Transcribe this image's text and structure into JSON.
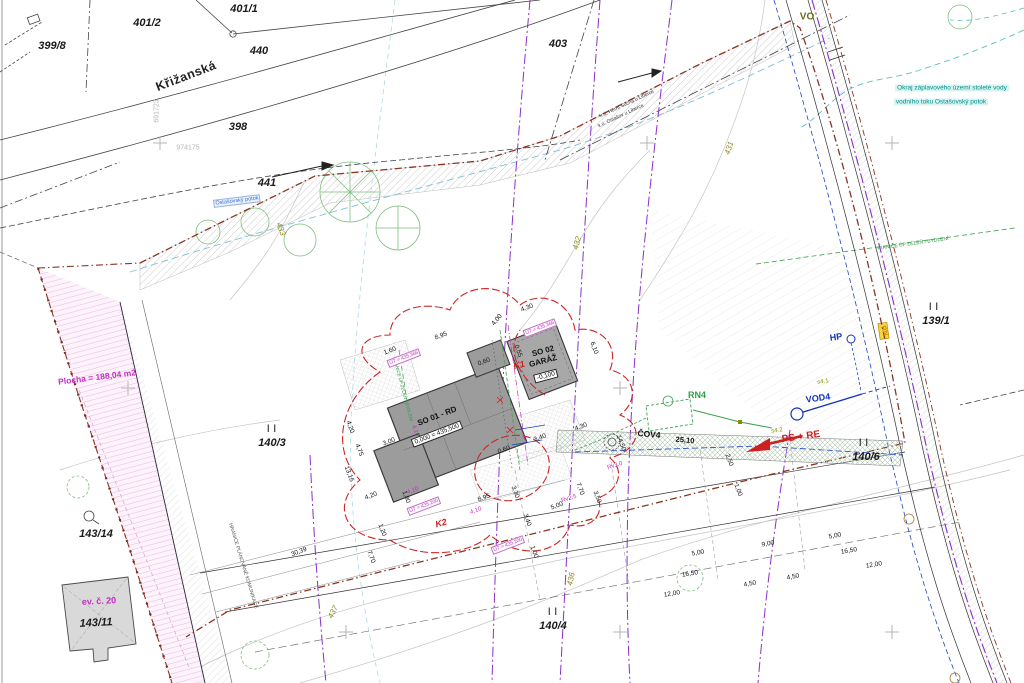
{
  "meta": {
    "title": "Koordinační situační výkres – site plan"
  },
  "colors": {
    "boundary_red": "#8A3522",
    "utility_purple": "#8B2FC9",
    "magenta": "#C42FC4",
    "green": "#2E9E45",
    "blue": "#1133BB",
    "teal": "#00928F",
    "olive": "#8A8A20",
    "building_gray": "#9C9C9C",
    "pink_area": "#FDF3FB"
  },
  "buildings": {
    "house": {
      "name": "SO 01 - RD",
      "level": "0,000 = 435,500"
    },
    "garage": {
      "name_line1": "SO 02",
      "name_line2": "GARÁŽ",
      "level": "-0,100"
    },
    "existing": {
      "name": "ev. č. 20",
      "parcel": "143/11"
    }
  },
  "notes": {
    "flood_line1": "Okraj záplavového území stoleté vody",
    "flood_line2": "vodního toku Ostašovský potok",
    "stream": "Ostašovský potok",
    "area": "Plocha = 188,04 m2",
    "green_boundary": "HRANICE ÚP ZELEŇ / BYDLENÍ",
    "road_boundary": "HRANICE PLÁNOVANÉ KOMUNIKACE",
    "cadastre1": "k.ú. Horní Suchá u Liberce",
    "cadastre2": "k.ú. Ostašov u Liberce"
  },
  "labels": {
    "parcels": [
      {
        "n": "parcel-399-8",
        "t": "399/8",
        "x": 52,
        "y": 46,
        "r": 0,
        "c": "parcel"
      },
      {
        "n": "parcel-401-2",
        "t": "401/2",
        "x": 147,
        "y": 23,
        "r": 0,
        "c": "parcel"
      },
      {
        "n": "parcel-401-1",
        "t": "401/1",
        "x": 244,
        "y": 9,
        "r": 0,
        "c": "parcel"
      },
      {
        "n": "parcel-440",
        "t": "440",
        "x": 259,
        "y": 51,
        "r": 0,
        "c": "parcel"
      },
      {
        "n": "parcel-398",
        "t": "398",
        "x": 238,
        "y": 127,
        "r": 0,
        "c": "parcel"
      },
      {
        "n": "parcel-441",
        "t": "441",
        "x": 267,
        "y": 183,
        "r": 0,
        "c": "parcel"
      },
      {
        "n": "parcel-403",
        "t": "403",
        "x": 558,
        "y": 44,
        "r": 0,
        "c": "parcel"
      },
      {
        "n": "parcel-139-1",
        "t": "139/1",
        "x": 936,
        "y": 321,
        "r": 0,
        "c": "parcel"
      },
      {
        "n": "parcel-140-3",
        "t": "140/3",
        "x": 272,
        "y": 443,
        "r": 0,
        "c": "parcel"
      },
      {
        "n": "parcel-140-4",
        "t": "140/4",
        "x": 553,
        "y": 626,
        "r": 0,
        "c": "parcel"
      },
      {
        "n": "parcel-140-6",
        "t": "140/6",
        "x": 866,
        "y": 457,
        "r": 0,
        "c": "parcel"
      },
      {
        "n": "parcel-143-14",
        "t": "143/14",
        "x": 96,
        "y": 534,
        "r": 0,
        "c": "parcel"
      },
      {
        "n": "parcel-143-11",
        "t": "143/11",
        "x": 96,
        "y": 623,
        "r": -3,
        "c": "parcel"
      },
      {
        "n": "parallel-mark",
        "t": "| |",
        "x": 272,
        "y": 428,
        "r": 0,
        "c": "pmark"
      },
      {
        "n": "parallel-mark",
        "t": "| |",
        "x": 553,
        "y": 611,
        "r": 0,
        "c": "pmark"
      },
      {
        "n": "parallel-mark",
        "t": "| |",
        "x": 864,
        "y": 442,
        "r": 0,
        "c": "pmark"
      },
      {
        "n": "parallel-mark",
        "t": "| |",
        "x": 934,
        "y": 306,
        "r": 0,
        "c": "pmark"
      }
    ],
    "street": [
      {
        "n": "street-name",
        "t": "Křižanská",
        "x": 186,
        "y": 76,
        "r": -21,
        "c": "street"
      }
    ],
    "cadastre": [
      {
        "n": "cadastre-line-1",
        "t": "k.ú. Horní Suchá u Liberce",
        "x": 627,
        "y": 104,
        "r": -25,
        "c": "cad"
      },
      {
        "n": "cadastre-line-2",
        "t": "k.ú. Ostašov u Liberce",
        "x": 621,
        "y": 116,
        "r": -25,
        "c": "cad"
      }
    ],
    "buildings": [
      {
        "n": "house-name",
        "t": "SO 01 - RD",
        "x": 437,
        "y": 416,
        "r": -21,
        "c": "bname"
      },
      {
        "n": "house-level",
        "t": "0,000 = 435,500",
        "x": 437,
        "y": 434,
        "r": -21,
        "c": "lvl"
      },
      {
        "n": "garage-name-1",
        "t": "SO 02",
        "x": 543,
        "y": 351,
        "r": -15,
        "c": "bname"
      },
      {
        "n": "garage-name-2",
        "t": "GARÁŽ",
        "x": 543,
        "y": 361,
        "r": -15,
        "c": "bname"
      },
      {
        "n": "garage-level",
        "t": "-0,100",
        "x": 546,
        "y": 376,
        "r": -15,
        "c": "lvl"
      },
      {
        "n": "existing-building-name",
        "t": "ev. č. 20",
        "x": 99,
        "y": 601,
        "r": -3,
        "c": "evc"
      }
    ],
    "utilities": [
      {
        "n": "label-vo",
        "t": "VO",
        "x": 807,
        "y": 17,
        "r": 0,
        "c": "vo"
      },
      {
        "n": "label-hp",
        "t": "HP",
        "x": 836,
        "y": 337,
        "r": -8,
        "c": "blue"
      },
      {
        "n": "label-vod4",
        "t": "VOD4",
        "x": 818,
        "y": 398,
        "r": -8,
        "c": "blue"
      },
      {
        "n": "label-ps-re",
        "t": "PS + RE",
        "x": 801,
        "y": 437,
        "r": -8,
        "c": "red"
      },
      {
        "n": "label-rn4",
        "t": "RN4",
        "x": 697,
        "y": 395,
        "r": 0,
        "c": "green"
      },
      {
        "n": "label-cov4",
        "t": "ČOV4",
        "x": 649,
        "y": 434,
        "r": 5,
        "c": "covl"
      },
      {
        "n": "label-cov4-dim",
        "t": "25,10",
        "x": 685,
        "y": 440,
        "r": 5,
        "c": "dimb"
      },
      {
        "n": "label-k2",
        "t": "K2",
        "x": 441,
        "y": 523,
        "r": -15,
        "c": "redi"
      },
      {
        "n": "label-k1",
        "t": "K1",
        "x": 519,
        "y": 365,
        "r": -15,
        "c": "redi"
      },
      {
        "n": "label-rn",
        "t": "RN",
        "x": 884,
        "y": 331,
        "r": 70,
        "c": "rn"
      },
      {
        "n": "label-s4-1",
        "t": "s4.1",
        "x": 823,
        "y": 382,
        "r": -8,
        "c": "olv"
      },
      {
        "n": "label-s4-2",
        "t": "s4.2",
        "x": 777,
        "y": 431,
        "r": -8,
        "c": "olv"
      }
    ],
    "notes": [
      {
        "n": "flood-note-line1",
        "t": "Okraj záplavového území stoleté vody",
        "x": 952,
        "y": 88,
        "r": 0,
        "c": "teal"
      },
      {
        "n": "flood-note-line2",
        "t": "vodního toku Ostašovský potok",
        "x": 941,
        "y": 102,
        "r": 0,
        "c": "teal"
      },
      {
        "n": "stream-label",
        "t": "Ostašovský potok",
        "x": 237,
        "y": 201,
        "r": -7,
        "c": "stream"
      },
      {
        "n": "area-label",
        "t": "Plocha = 188,04 m2",
        "x": 97,
        "y": 377,
        "r": -7,
        "c": "area"
      },
      {
        "n": "green-boundary-note",
        "t": "HRANICE ÚP ZELEŇ / BYDLENÍ",
        "x": 912,
        "y": 244,
        "r": -8,
        "c": "noteg"
      },
      {
        "n": "green-boundary-note-2",
        "t": "HRANICE ÚP ZELEŇ / BYDLENÍ",
        "x": 403,
        "y": 389,
        "r": 75,
        "c": "notegs"
      },
      {
        "n": "road-boundary-note",
        "t": "HRANICE PLÁNOVANÉ KOMUNIKACE",
        "x": 243,
        "y": 566,
        "r": 73,
        "c": "notek"
      }
    ],
    "contours": [
      {
        "n": "contour-431",
        "t": "431",
        "x": 729,
        "y": 148,
        "r": -72,
        "c": "contour"
      },
      {
        "n": "contour-432",
        "t": "432",
        "x": 577,
        "y": 243,
        "r": -75,
        "c": "contour"
      },
      {
        "n": "contour-433",
        "t": "433",
        "x": 281,
        "y": 229,
        "r": 70,
        "c": "contour"
      },
      {
        "n": "contour-436",
        "t": "436",
        "x": 571,
        "y": 579,
        "r": -78,
        "c": "contour"
      },
      {
        "n": "contour-437",
        "t": "437",
        "x": 333,
        "y": 612,
        "r": -62,
        "c": "contour"
      }
    ],
    "coordinates": [
      {
        "n": "coord-974175",
        "t": "974175",
        "x": 188,
        "y": 148,
        "r": 0,
        "c": "coord"
      },
      {
        "n": "coord-691723",
        "t": "691723",
        "x": 157,
        "y": 111,
        "r": -90,
        "c": "coord"
      }
    ],
    "magenta": [
      {
        "n": "ut-level",
        "t": "ÚT = 435,366",
        "x": 404,
        "y": 358,
        "r": -21,
        "c": "magbox"
      },
      {
        "n": "ut-level",
        "t": "ÚT = 435,366",
        "x": 540,
        "y": 328,
        "r": -21,
        "c": "magbox"
      },
      {
        "n": "ut-level",
        "t": "ÚT = 435,200",
        "x": 424,
        "y": 506,
        "r": -21,
        "c": "magbox"
      },
      {
        "n": "ut-level",
        "t": "ÚT = 435,200",
        "x": 508,
        "y": 545,
        "r": -21,
        "c": "magbox"
      },
      {
        "n": "mag-dim",
        "t": "4,10",
        "x": 413,
        "y": 491,
        "r": -21,
        "c": "mag"
      },
      {
        "n": "mag-dim",
        "t": "4,10",
        "x": 476,
        "y": 511,
        "r": -21,
        "c": "mag"
      },
      {
        "n": "mag-dim",
        "t": "4,10",
        "x": 415,
        "y": 431,
        "r": 70,
        "c": "mag"
      },
      {
        "n": "mag-rv",
        "t": "Rv3,0",
        "x": 615,
        "y": 466,
        "r": -18,
        "c": "mag"
      },
      {
        "n": "mag-rv",
        "t": "Rv2,5",
        "x": 569,
        "y": 499,
        "r": -18,
        "c": "mag"
      }
    ],
    "dimensions": [
      {
        "n": "dim",
        "t": "1,60",
        "x": 390,
        "y": 351,
        "r": -21,
        "c": "dim"
      },
      {
        "n": "dim",
        "t": "8,95",
        "x": 441,
        "y": 336,
        "r": -21,
        "c": "dim"
      },
      {
        "n": "dim",
        "t": "4,00",
        "x": 497,
        "y": 320,
        "r": -50,
        "c": "dim"
      },
      {
        "n": "dim",
        "t": "4,30",
        "x": 527,
        "y": 308,
        "r": -21,
        "c": "dim"
      },
      {
        "n": "dim",
        "t": "0,60",
        "x": 484,
        "y": 362,
        "r": -21,
        "c": "dim"
      },
      {
        "n": "dim",
        "t": "0,60",
        "x": 504,
        "y": 450,
        "r": -21,
        "c": "dim"
      },
      {
        "n": "dim",
        "t": "3,40",
        "x": 540,
        "y": 438,
        "r": -21,
        "c": "dim"
      },
      {
        "n": "dim",
        "t": "4,30",
        "x": 581,
        "y": 427,
        "r": -21,
        "c": "dim"
      },
      {
        "n": "dim",
        "t": "3,00",
        "x": 389,
        "y": 442,
        "r": -21,
        "c": "dim"
      },
      {
        "n": "dim",
        "t": "8,95",
        "x": 484,
        "y": 498,
        "r": -21,
        "c": "dim"
      },
      {
        "n": "dim",
        "t": "4,20",
        "x": 371,
        "y": 496,
        "r": -21,
        "c": "dim"
      },
      {
        "n": "dim",
        "t": "30,39",
        "x": 299,
        "y": 552,
        "r": -21,
        "c": "dim"
      },
      {
        "n": "dim",
        "t": "5,00",
        "x": 557,
        "y": 506,
        "r": -21,
        "c": "dim"
      },
      {
        "n": "dim",
        "t": "4,20",
        "x": 350,
        "y": 427,
        "r": 70,
        "c": "dim"
      },
      {
        "n": "dim",
        "t": "4,75",
        "x": 359,
        "y": 450,
        "r": 70,
        "c": "dim"
      },
      {
        "n": "dim",
        "t": "13,15",
        "x": 349,
        "y": 474,
        "r": 70,
        "c": "dim"
      },
      {
        "n": "dim",
        "t": "1,80",
        "x": 406,
        "y": 497,
        "r": 70,
        "c": "dim"
      },
      {
        "n": "dim",
        "t": "1,20",
        "x": 382,
        "y": 530,
        "r": 70,
        "c": "dim"
      },
      {
        "n": "dim",
        "t": "7,70",
        "x": 371,
        "y": 557,
        "r": 70,
        "c": "dim"
      },
      {
        "n": "dim",
        "t": "0,55",
        "x": 518,
        "y": 351,
        "r": 70,
        "c": "dim"
      },
      {
        "n": "dim",
        "t": "6,10",
        "x": 594,
        "y": 348,
        "r": 70,
        "c": "dim"
      },
      {
        "n": "dim",
        "t": "14,50",
        "x": 621,
        "y": 443,
        "r": 70,
        "c": "dim"
      },
      {
        "n": "dim",
        "t": "3,30",
        "x": 515,
        "y": 492,
        "r": 70,
        "c": "dim"
      },
      {
        "n": "dim",
        "t": "3,40",
        "x": 527,
        "y": 520,
        "r": 70,
        "c": "dim"
      },
      {
        "n": "dim",
        "t": "7,70",
        "x": 580,
        "y": 489,
        "r": 70,
        "c": "dim"
      },
      {
        "n": "dim",
        "t": "3,50",
        "x": 597,
        "y": 497,
        "r": 70,
        "c": "dim"
      },
      {
        "n": "dim",
        "t": "1,00",
        "x": 534,
        "y": 552,
        "r": 70,
        "c": "dim"
      },
      {
        "n": "dim",
        "t": "2,50",
        "x": 729,
        "y": 460,
        "r": 70,
        "c": "dim"
      },
      {
        "n": "dim",
        "t": "1,00",
        "x": 738,
        "y": 490,
        "r": 70,
        "c": "dim"
      },
      {
        "n": "dim",
        "t": "5,00",
        "x": 698,
        "y": 553,
        "r": -10,
        "c": "dim"
      },
      {
        "n": "dim",
        "t": "16,50",
        "x": 690,
        "y": 574,
        "r": -10,
        "c": "dim"
      },
      {
        "n": "dim",
        "t": "12,00",
        "x": 672,
        "y": 594,
        "r": -10,
        "c": "dim"
      },
      {
        "n": "dim",
        "t": "4,50",
        "x": 750,
        "y": 584,
        "r": -10,
        "c": "dim"
      },
      {
        "n": "dim",
        "t": "4,50",
        "x": 793,
        "y": 577,
        "r": -10,
        "c": "dim"
      },
      {
        "n": "dim",
        "t": "9,00",
        "x": 768,
        "y": 544,
        "r": -10,
        "c": "dim"
      },
      {
        "n": "dim",
        "t": "5,00",
        "x": 835,
        "y": 536,
        "r": -10,
        "c": "dim"
      },
      {
        "n": "dim",
        "t": "16,50",
        "x": 849,
        "y": 551,
        "r": -10,
        "c": "dim"
      },
      {
        "n": "dim",
        "t": "12,00",
        "x": 874,
        "y": 565,
        "r": -10,
        "c": "dim"
      }
    ]
  }
}
